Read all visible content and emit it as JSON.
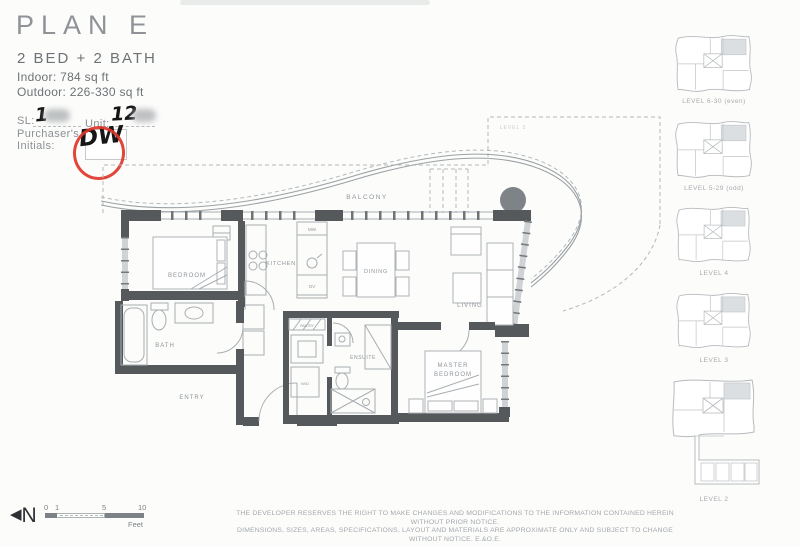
{
  "header": {
    "plan_name": "PLAN E",
    "plan_type": "2 BED + 2 BATH",
    "indoor_area": "Indoor: 784 sq ft",
    "outdoor_area": "Outdoor: 226-330 sq ft"
  },
  "unit_info": {
    "sl_label": "SL:",
    "sl_value": "1",
    "unit_label": "Unit:",
    "unit_value": "12",
    "initials_label_line1": "Purchaser's",
    "initials_label_line2": "Initials:",
    "initials_value": "DW"
  },
  "floor_plan": {
    "labels": {
      "balcony": "BALCONY",
      "level_note": "LEVEL 3",
      "bedroom": "BEDROOM",
      "kitchen": "KITCHEN",
      "dining": "DINING",
      "living": "LIVING",
      "bath": "BATH",
      "entry": "ENTRY",
      "ensuite": "ENSUITE",
      "master_line1": "MASTER",
      "master_line2": "BEDROOM",
      "pantry": "PANTRY",
      "washer_dryer": "W/D",
      "microwave": "MW",
      "oven": "OV"
    }
  },
  "key_plans": [
    {
      "label": "LEVEL 6-30 (even)"
    },
    {
      "label": "LEVEL 5-29 (odd)"
    },
    {
      "label": "LEVEL 4"
    },
    {
      "label": "LEVEL 3"
    },
    {
      "label": "LEVEL 2"
    }
  ],
  "footer": {
    "north_label": "N",
    "scale": {
      "ticks": [
        "0",
        "1",
        "5",
        "10"
      ],
      "unit": "Feet"
    },
    "disclaimer_line1": "THE DEVELOPER RESERVES THE RIGHT TO MAKE CHANGES AND MODIFICATIONS TO THE INFORMATION CONTAINED HEREIN WITHOUT PRIOR NOTICE.",
    "disclaimer_line2": "DIMENSIONS, SIZES, AREAS, SPECIFICATIONS, LAYOUT AND MATERIALS ARE APPROXIMATE ONLY AND SUBJECT TO CHANGE WITHOUT NOTICE. E.&O.E."
  },
  "colors": {
    "accent_red": "#e03529",
    "ink": "#161616",
    "plan_line": "#9aa0a4",
    "wall": "#55595c",
    "label_gray": "#8f959a"
  }
}
